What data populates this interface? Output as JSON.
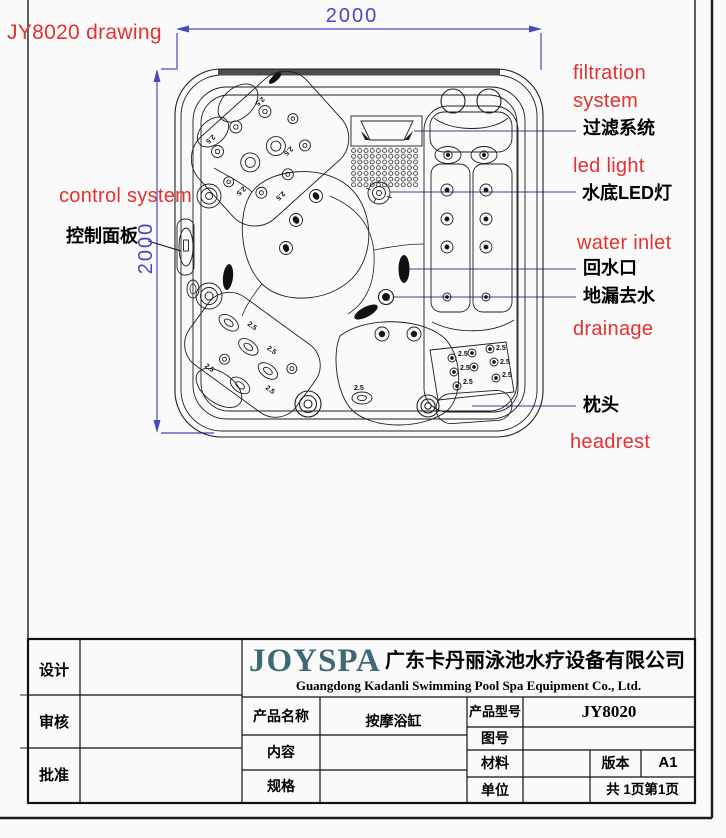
{
  "drawing": {
    "title": "JY8020 drawing",
    "dim_top": "2000",
    "dim_left": "2000",
    "jet_label": "2.5",
    "colors": {
      "red": "#e62f2f",
      "dim_blue": "#4a45c0",
      "leader_blue": "#3c3c9e"
    },
    "labels": {
      "control_system_en": "control system",
      "control_panel_cn": "控制面板",
      "filtration_en_1": "filtration",
      "filtration_en_2": "system",
      "filtration_cn": "过滤系统",
      "led_en": "led light",
      "led_cn": "水底LED灯",
      "water_inlet_en": "water inlet",
      "water_inlet_cn": "回水口",
      "drain_cn": "地漏去水",
      "drainage_en": "drainage",
      "headrest_cn": "枕头",
      "headrest_en": "headrest"
    }
  },
  "title_block": {
    "design_label": "设计",
    "review_label": "审核",
    "approve_label": "批准",
    "brand": "JOYSPA",
    "brand_color": "#3e6876",
    "company_cn": "广东卡丹丽泳池水疗设备有限公司",
    "company_en": "Guangdong Kadanli Swimming Pool Spa Equipment Co., Ltd.",
    "product_name_label": "产品名称",
    "product_name": "按摩浴缸",
    "model_label": "产品型号",
    "model": "JY8020",
    "drawing_no_label": "图号",
    "content_label": "内容",
    "material_label": "材料",
    "version_label": "版本",
    "version": "A1",
    "spec_label": "规格",
    "unit_label": "单位",
    "pages": "共 1页第1页"
  }
}
